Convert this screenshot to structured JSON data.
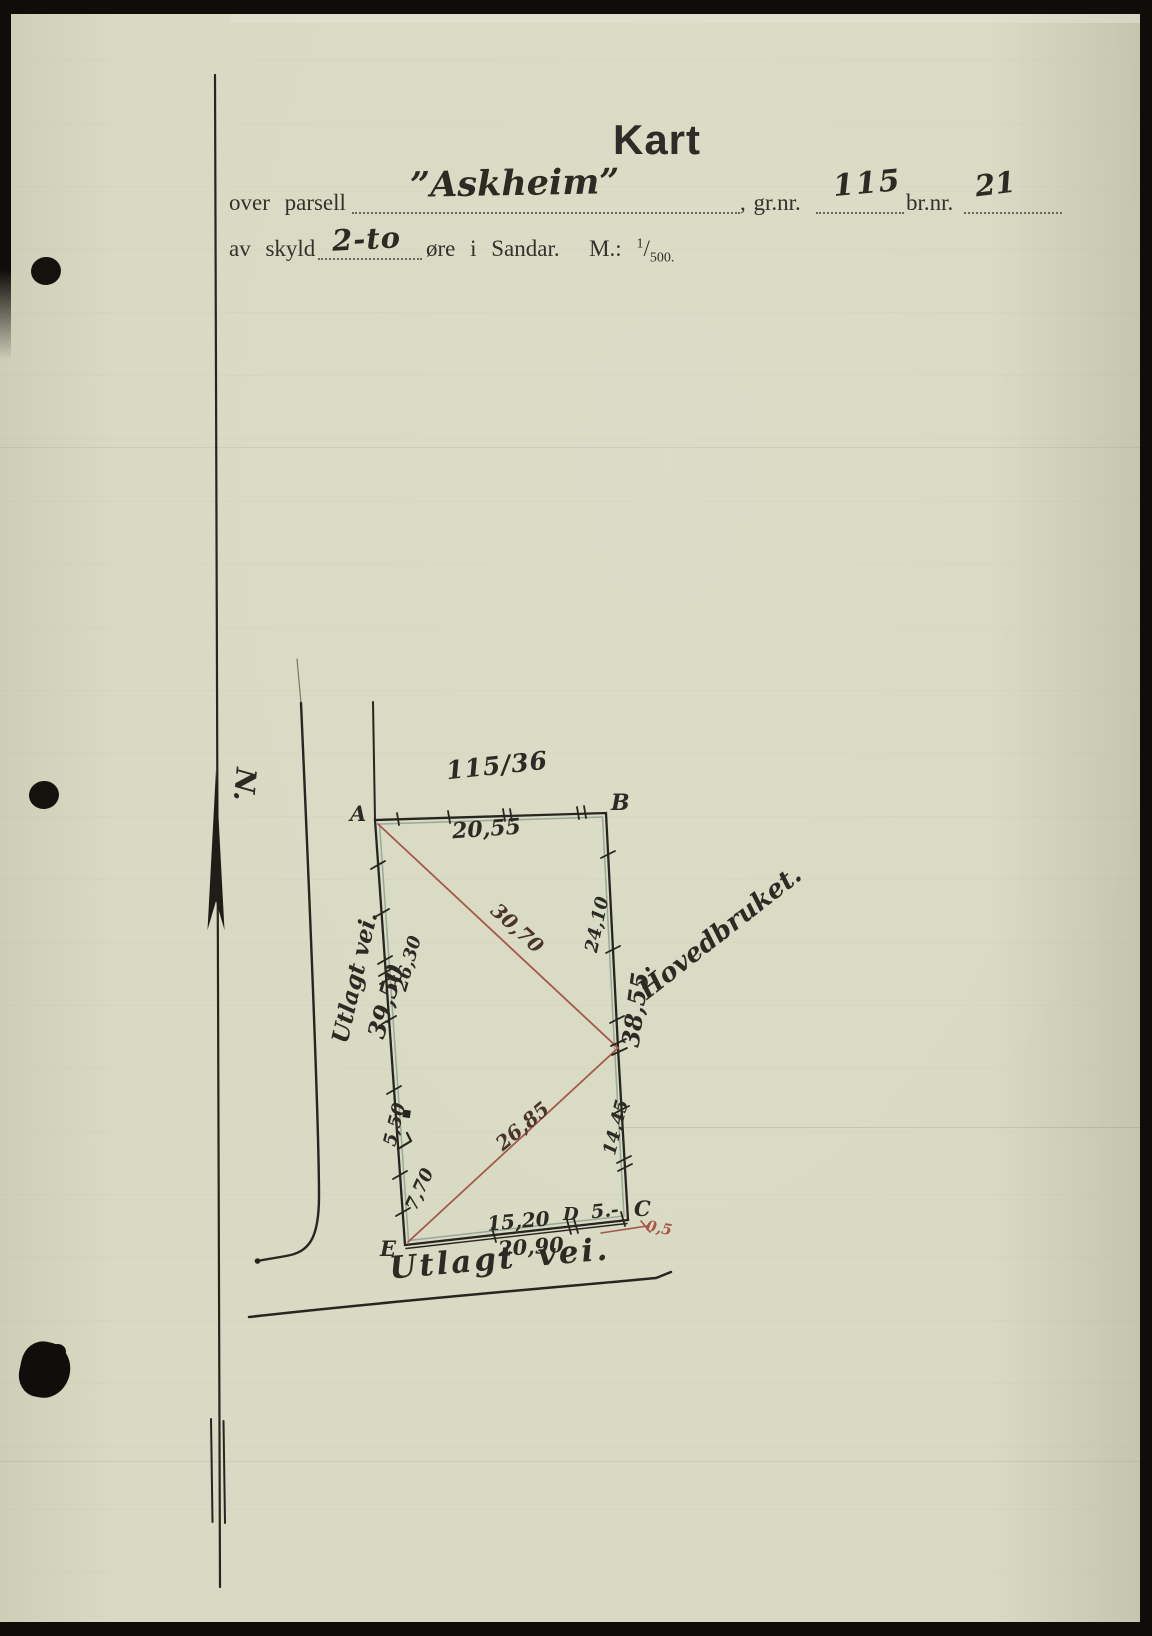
{
  "page": {
    "title": "Kart"
  },
  "form": {
    "over_parsell_label": "over parsell",
    "parcel_name": "”Askheim”",
    "gr_nr_label": ", gr.nr.",
    "gr_nr_value": "115",
    "br_nr_label": "br.nr.",
    "br_nr_value": "21",
    "av_skyld_label": "av skyld",
    "skyld_value": "2-to",
    "skyld_suffix": "øre i Sandar.",
    "scale_label": "M.:",
    "scale_numerator": "1",
    "scale_denominator": "500."
  },
  "map": {
    "north": "N.",
    "parcel_ref": "115/36",
    "neighbor": "Hovedbruket.",
    "road_left": "Utlagt vei.",
    "road_bottom": "Utlagt vei.",
    "points": {
      "a": "A",
      "b": "B",
      "c": "C",
      "d": "D",
      "e": "E"
    },
    "lengths": {
      "top": "20,55",
      "right_upper": "24,10",
      "right_total": "38,55.",
      "right_lower": "14,45",
      "left_upper": "26,30",
      "left_total": "39,50",
      "left_mid": "5,50",
      "left_lower": "7,70",
      "bottom_left": "15,20",
      "bottom_right": "5.-",
      "bottom_total": "20,90",
      "diag_upper": "30,70",
      "diag_lower": "26,85",
      "corner_offset": "0,5"
    }
  },
  "colors": {
    "paper": "#d8dac3",
    "ink": "#26251f",
    "red_ink": "#a5574a",
    "boundary_shade_green": "#93a795"
  }
}
